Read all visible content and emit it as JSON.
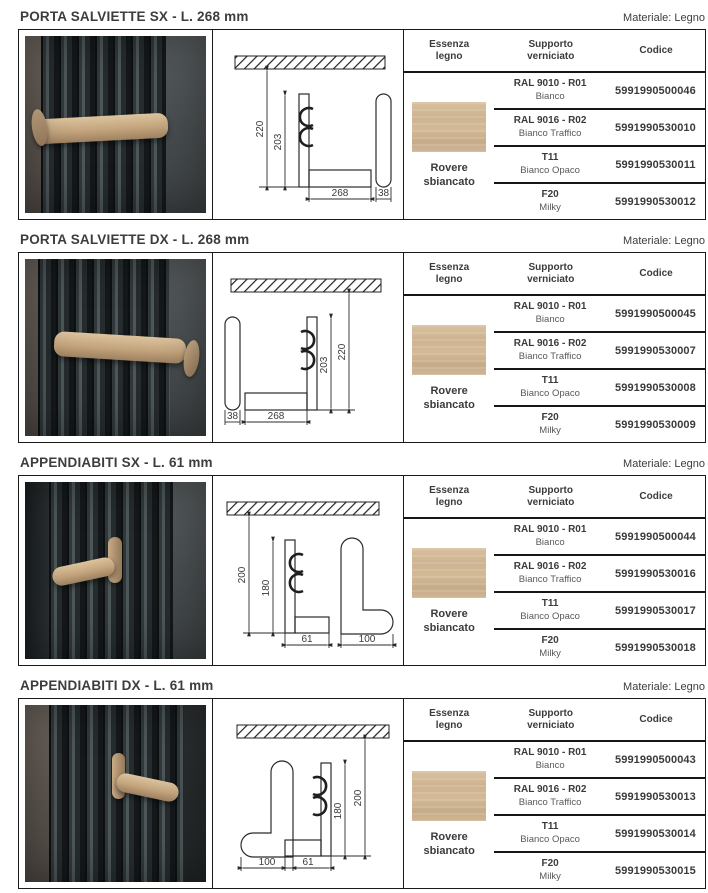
{
  "sections": [
    {
      "title": "PORTA SALVIETTE SX - L. 268 mm",
      "materiale": "Materiale: Legno",
      "drawing": {
        "dim_wall": "220",
        "dim_plate": "203",
        "dim_length": "268",
        "dim_side": "38"
      },
      "table": {
        "col1": "Essenza legno",
        "col2": "Supporto verniciato",
        "col3": "Codice",
        "essenza": "Rovere sbiancato",
        "rows": [
          {
            "finish": "RAL 9010 - R01",
            "sub": "Bianco",
            "code": "5991990500046"
          },
          {
            "finish": "RAL 9016 - R02",
            "sub": "Bianco Traffico",
            "code": "5991990530010"
          },
          {
            "finish": "T11",
            "sub": "Bianco Opaco",
            "code": "5991990530011"
          },
          {
            "finish": "F20",
            "sub": "Milky",
            "code": "5991990530012"
          }
        ]
      }
    },
    {
      "title": "PORTA SALVIETTE DX - L. 268 mm",
      "materiale": "Materiale: Legno",
      "drawing": {
        "dim_wall": "220",
        "dim_plate": "203",
        "dim_length": "268",
        "dim_side": "38"
      },
      "table": {
        "col1": "Essenza legno",
        "col2": "Supporto verniciato",
        "col3": "Codice",
        "essenza": "Rovere sbiancato",
        "rows": [
          {
            "finish": "RAL 9010 - R01",
            "sub": "Bianco",
            "code": "5991990500045"
          },
          {
            "finish": "RAL 9016 - R02",
            "sub": "Bianco Traffico",
            "code": "5991990530007"
          },
          {
            "finish": "T11",
            "sub": "Bianco Opaco",
            "code": "5991990530008"
          },
          {
            "finish": "F20",
            "sub": "Milky",
            "code": "5991990530009"
          }
        ]
      }
    },
    {
      "title": "APPENDIABITI SX - L. 61 mm",
      "materiale": "Materiale: Legno",
      "drawing": {
        "dim_wall": "200",
        "dim_plate": "180",
        "dim_length": "61",
        "dim_side": "100"
      },
      "table": {
        "col1": "Essenza legno",
        "col2": "Supporto verniciato",
        "col3": "Codice",
        "essenza": "Rovere sbiancato",
        "rows": [
          {
            "finish": "RAL 9010 - R01",
            "sub": "Bianco",
            "code": "5991990500044"
          },
          {
            "finish": "RAL 9016 - R02",
            "sub": "Bianco Traffico",
            "code": "5991990530016"
          },
          {
            "finish": "T11",
            "sub": "Bianco Opaco",
            "code": "5991990530017"
          },
          {
            "finish": "F20",
            "sub": "Milky",
            "code": "5991990530018"
          }
        ]
      }
    },
    {
      "title": "APPENDIABITI DX - L. 61 mm",
      "materiale": "Materiale: Legno",
      "drawing": {
        "dim_wall": "200",
        "dim_plate": "180",
        "dim_length": "61",
        "dim_side": "100"
      },
      "table": {
        "col1": "Essenza legno",
        "col2": "Supporto verniciato",
        "col3": "Codice",
        "essenza": "Rovere sbiancato",
        "rows": [
          {
            "finish": "RAL 9010 - R01",
            "sub": "Bianco",
            "code": "5991990500043"
          },
          {
            "finish": "RAL 9016 - R02",
            "sub": "Bianco Traffico",
            "code": "5991990530013"
          },
          {
            "finish": "T11",
            "sub": "Bianco Opaco",
            "code": "5991990530014"
          },
          {
            "finish": "F20",
            "sub": "Milky",
            "code": "5991990530015"
          }
        ]
      }
    }
  ]
}
